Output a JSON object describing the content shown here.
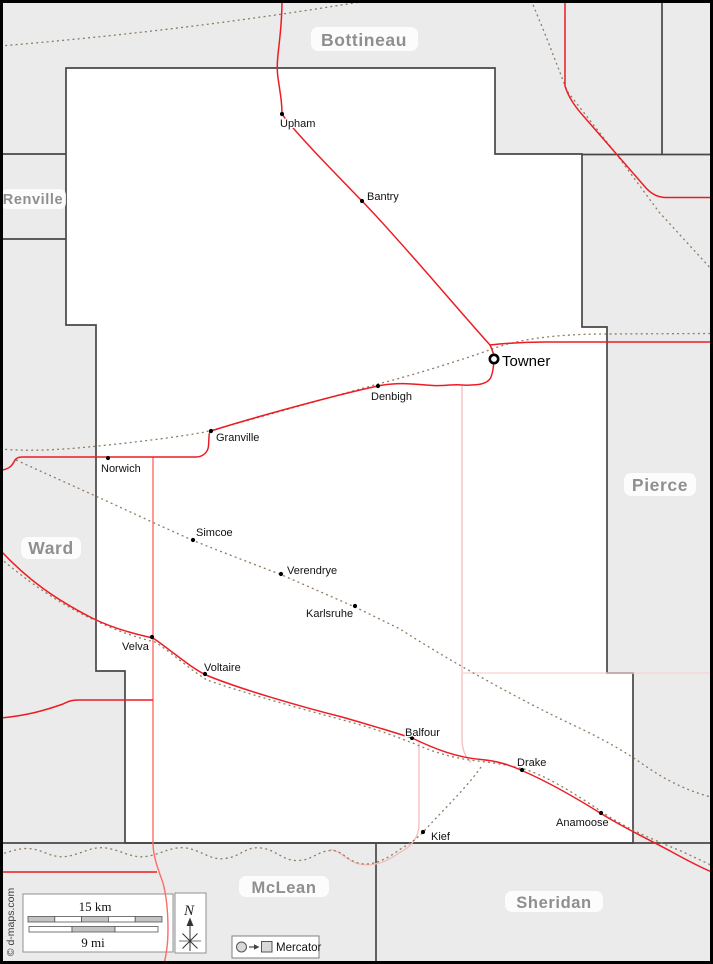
{
  "map_type": "county-road-map",
  "neighbors": [
    {
      "name": "Bottineau"
    },
    {
      "name": "Renville"
    },
    {
      "name": "Pierce"
    },
    {
      "name": "Ward"
    },
    {
      "name": "McLean"
    },
    {
      "name": "Sheridan"
    }
  ],
  "seat": {
    "name": "Towner"
  },
  "cities": [
    {
      "name": "Upham"
    },
    {
      "name": "Bantry"
    },
    {
      "name": "Denbigh"
    },
    {
      "name": "Granville"
    },
    {
      "name": "Norwich"
    },
    {
      "name": "Simcoe"
    },
    {
      "name": "Verendrye"
    },
    {
      "name": "Karlsruhe"
    },
    {
      "name": "Velva"
    },
    {
      "name": "Voltaire"
    },
    {
      "name": "Balfour"
    },
    {
      "name": "Drake"
    },
    {
      "name": "Anamoose"
    },
    {
      "name": "Kief"
    }
  ],
  "legend": {
    "scale_km": "15 km",
    "scale_mi": "9 mi",
    "north": "N",
    "projection": "Mercator",
    "credit": "© d-maps.com"
  },
  "colors": {
    "background": "#ebebeb",
    "county_fill": "#ffffff",
    "boundary": "#474747",
    "road_primary": "#ed1c24",
    "road_secondary": "#ff6b66",
    "road_minor": "#f6bcbc",
    "road_faint": "#f9d2d2",
    "railway": "#8e7c64",
    "county_label": "#8f8f8f"
  }
}
